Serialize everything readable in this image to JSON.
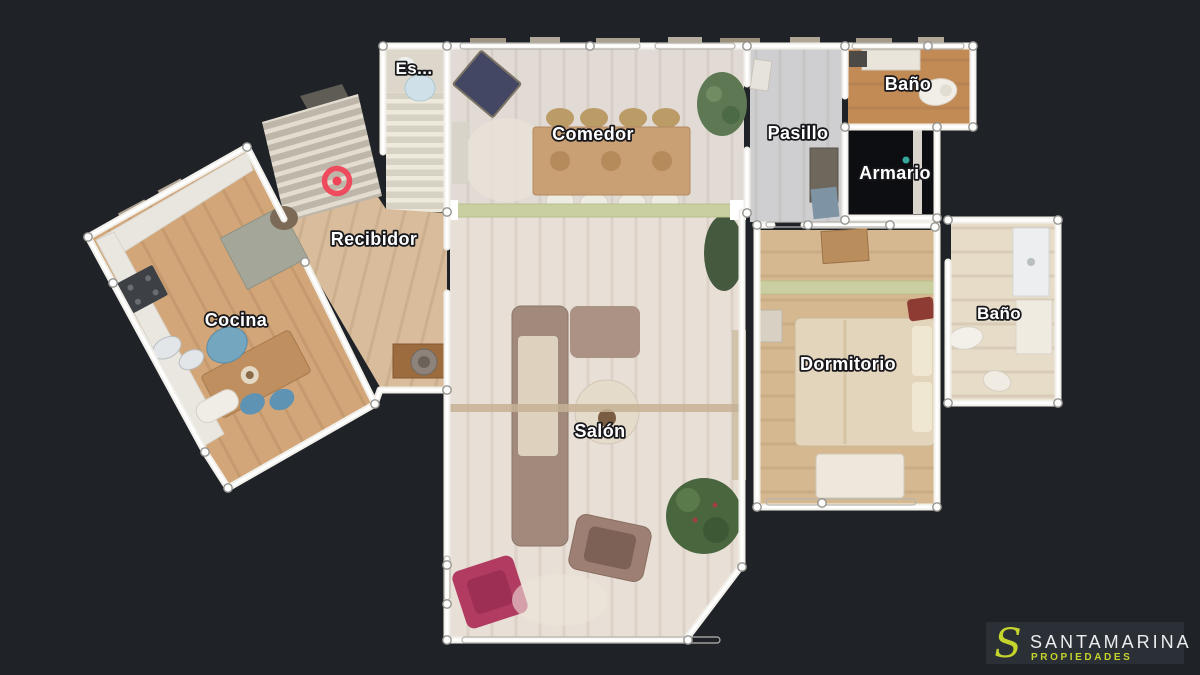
{
  "canvas": {
    "width": 1200,
    "height": 675,
    "background": "#1f2227"
  },
  "floorplan": {
    "wall_color": "#ffffff",
    "glass_partition_color": "#c9cfa0",
    "tag": {
      "color": "#ef4458",
      "x": 337,
      "y": 181
    },
    "rooms": [
      {
        "id": "escalera",
        "label": "Es..."
      },
      {
        "id": "comedor",
        "label": "Comedor"
      },
      {
        "id": "pasillo",
        "label": "Pasillo"
      },
      {
        "id": "bano_superior",
        "label": "Baño"
      },
      {
        "id": "armario",
        "label": "Armario"
      },
      {
        "id": "recibidor",
        "label": "Recibidor"
      },
      {
        "id": "cocina",
        "label": "Cocina"
      },
      {
        "id": "salon",
        "label": "Salón"
      },
      {
        "id": "dormitorio",
        "label": "Dormitorio"
      },
      {
        "id": "bano_derecho",
        "label": "Baño"
      }
    ]
  },
  "logo": {
    "initial": "S",
    "brand": "SANTAMARINA",
    "tagline": "PROPIEDADES",
    "accent_color": "#c5d32d",
    "brand_color": "#ecedee",
    "box_color": "#2b2f36"
  }
}
